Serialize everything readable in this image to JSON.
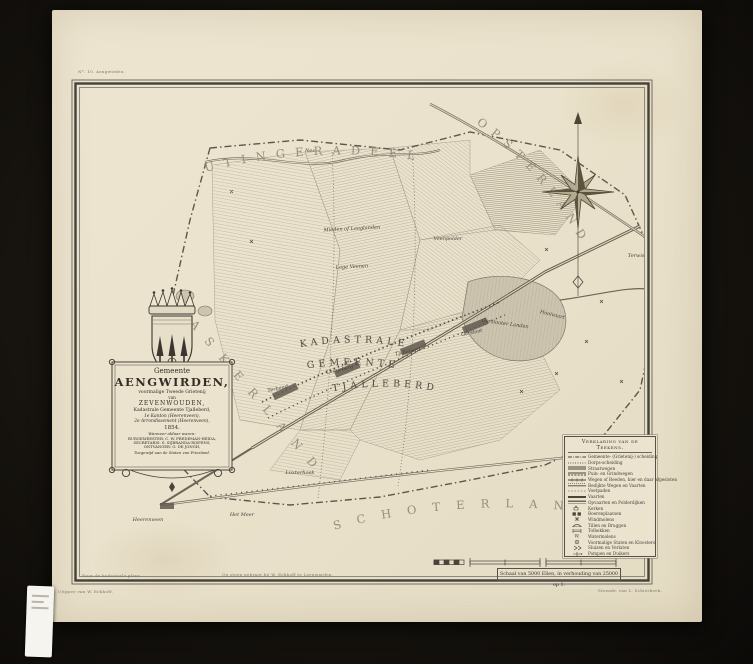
{
  "palette": {
    "background": "#17140f",
    "paper": "#eae2cc",
    "ink": "#3c372f",
    "hatch": "#a89e89",
    "region_text": "#978d7c"
  },
  "cartouche": {
    "lines": [
      "Gemeente",
      "AENGWIRDEN,",
      "voormalige Tweede Grietenij",
      "van",
      "ZEVENWOUDEN,",
      "Kadastrale Gemeente Tjalleberd,",
      "1e Kanton (Heerenveen),",
      "2e Arrondissement (Heerenveen),",
      "1854.",
      "Wanneer aldaar waren:",
      "BURGEMEESTER: C. W. FREDEMAN-HEIDA,",
      "SECRETARIS: S. SIJBRANDA-RISPENS,",
      "ONTVANGER: G. DE JONGH,",
      "Toegewijd aan de Staten van Friesland."
    ]
  },
  "map": {
    "regions": [
      "UTINGERADEEL",
      "OPSTERLAND",
      "SCHOTERLAND",
      "HASKERLAND"
    ],
    "kadastrale": [
      "KADASTRALE",
      "GEMEENTE",
      "TJALLEBERD"
    ],
    "labels": [
      {
        "t": "Nes",
        "x": 310,
        "y": 152,
        "r": 0,
        "s": 4.6
      },
      {
        "t": "Mieden of Laaglanden",
        "x": 352,
        "y": 230,
        "r": -3,
        "s": 5
      },
      {
        "t": "Lage Veenen",
        "x": 352,
        "y": 268,
        "r": -3,
        "s": 5
      },
      {
        "t": "Veenpolder",
        "x": 448,
        "y": 240,
        "r": 0,
        "s": 4.6
      },
      {
        "t": "Terband",
        "x": 278,
        "y": 390,
        "r": -12,
        "s": 5.2
      },
      {
        "t": "Luinjeberd",
        "x": 340,
        "y": 371,
        "r": -12,
        "s": 5.2
      },
      {
        "t": "Tjalleberd",
        "x": 408,
        "y": 353,
        "r": -12,
        "s": 5.2
      },
      {
        "t": "Gersloot",
        "x": 472,
        "y": 334,
        "r": -12,
        "s": 5.2
      },
      {
        "t": "Gerslooter Landen",
        "x": 505,
        "y": 325,
        "r": 8,
        "s": 4.4
      },
      {
        "t": "Hooivaart",
        "x": 552,
        "y": 316,
        "r": 14,
        "s": 4.4
      },
      {
        "t": "Heerenveen",
        "x": 148,
        "y": 521,
        "r": 0,
        "s": 5
      },
      {
        "t": "Het Meer",
        "x": 242,
        "y": 516,
        "r": 0,
        "s": 4.6
      },
      {
        "t": "Luxterhoek",
        "x": 300,
        "y": 474,
        "r": 0,
        "s": 4.4
      },
      {
        "t": "Terwispel",
        "x": 640,
        "y": 257,
        "r": 0,
        "s": 4.6
      }
    ]
  },
  "legend": {
    "title": "Verklaring van de Teekens.",
    "items": [
      {
        "sym": "gemeente-boundary",
        "label": "Gemeente- (Grietenij-) scheiding"
      },
      {
        "sym": "dorps-boundary",
        "label": "Dorps-scheiding"
      },
      {
        "sym": "straatweg",
        "label": "Straatwegen"
      },
      {
        "sym": "grindweg",
        "label": "Puin- en Grindwegen"
      },
      {
        "sym": "reedweg",
        "label": "Wegen of Reeden, hier en daar afgesloten"
      },
      {
        "sym": "dijkweg",
        "label": "Bedijkte Wegen en Vaarten"
      },
      {
        "sym": "voetpad",
        "label": "Voetpaden"
      },
      {
        "sym": "vaart",
        "label": "Vaarten"
      },
      {
        "sym": "opvaart",
        "label": "Opvaarten en Polderdijken"
      },
      {
        "sym": "kerk",
        "label": "Kerken"
      },
      {
        "sym": "boerenplaats",
        "label": "Boerenplaatsen"
      },
      {
        "sym": "windmolen",
        "label": "Windmolens"
      },
      {
        "sym": "brug",
        "label": "Tillen en Bruggen"
      },
      {
        "sym": "tolhek",
        "label": "Tolhekken"
      },
      {
        "sym": "watermolen",
        "label": "Watermolens"
      },
      {
        "sym": "state",
        "label": "Voormalige Staten en Kloosters"
      },
      {
        "sym": "sluis",
        "label": "Sluizen en Verlaten"
      },
      {
        "sym": "pomp",
        "label": "Pompen en Duikers"
      }
    ]
  },
  "scale": {
    "caption": "Schaal van 5000 Ellen, in verhouding van 25000 op 1."
  },
  "credits": {
    "top_left": "N°. 10. Aengwirden.",
    "under_left": "Uitgave van W. Eekhoff.",
    "inside_left": "Naar de kadastrale plans.",
    "inside_center": "Op steen gebragt bij W. Eekhoff te Leeuwarden.",
    "under_right": "Steendr. van L. Schierbeek."
  }
}
